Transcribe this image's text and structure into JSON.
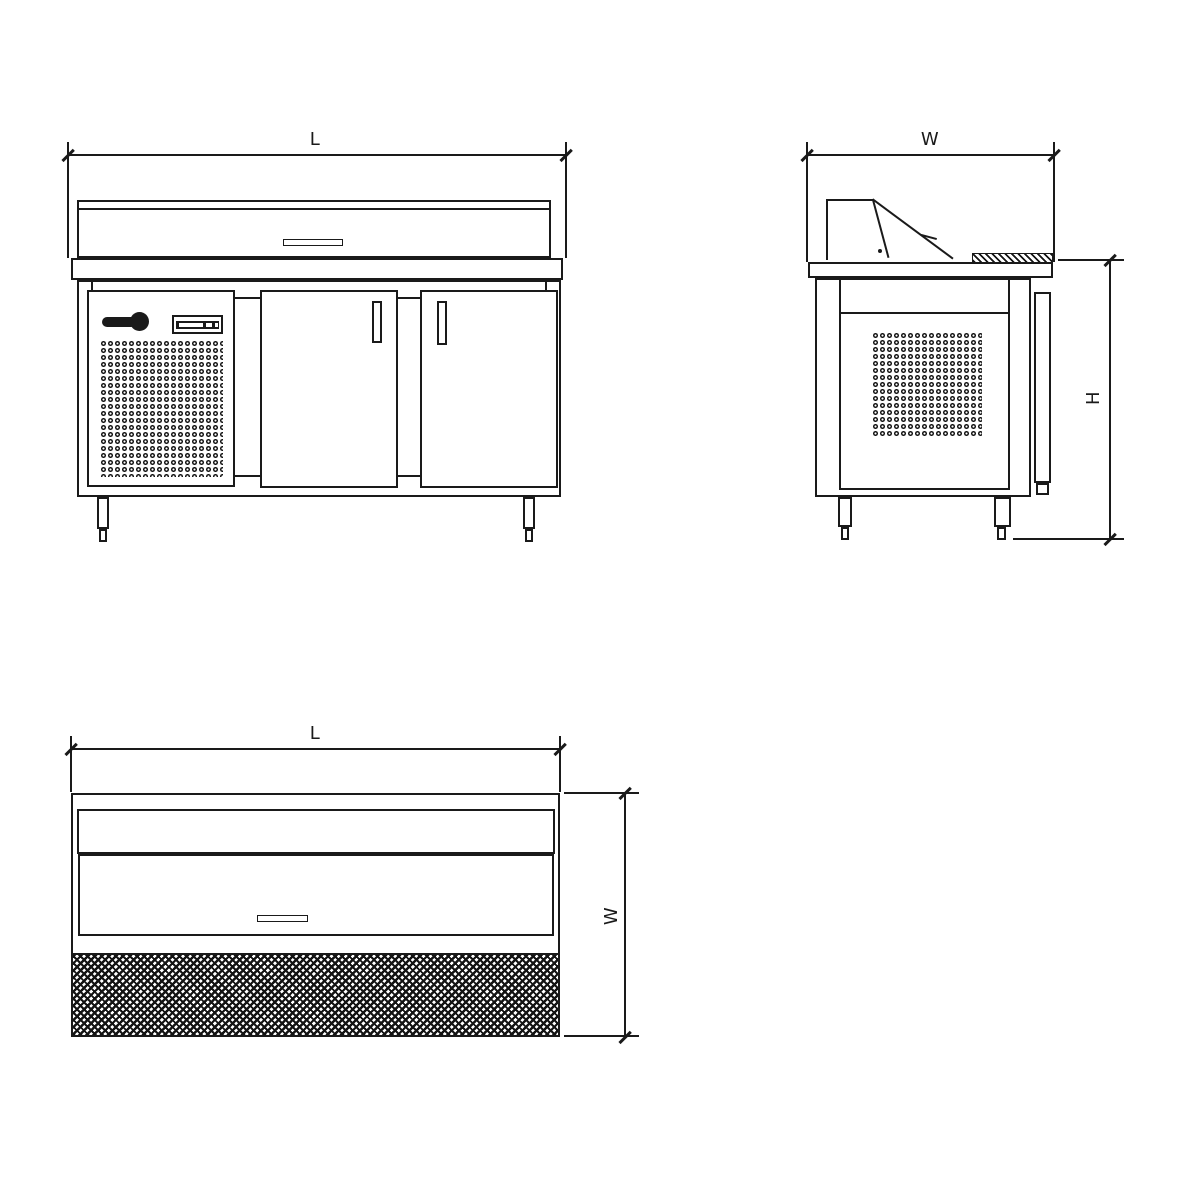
{
  "drawing": {
    "background_color": "#ffffff",
    "line_color": "#1a1a1a",
    "views": {
      "front_elevation": {
        "dim_length_label": "L"
      },
      "side_elevation": {
        "dim_width_label": "W",
        "dim_height_label": "H"
      },
      "top_plan": {
        "dim_length_label": "L",
        "dim_width_label": "W"
      }
    },
    "icons": {
      "brand_logo": "fagor-logo-mark (bar + dot, CSS shapes)",
      "controller": "controller-display (bordered box with slots)",
      "front_vent": "perforated-grille (ring pattern)",
      "side_vent": "perforated-grille (ring pattern)",
      "cutting_board": "diagonal-hatch strip",
      "plan_worktop": "dense crosshatch band"
    }
  }
}
